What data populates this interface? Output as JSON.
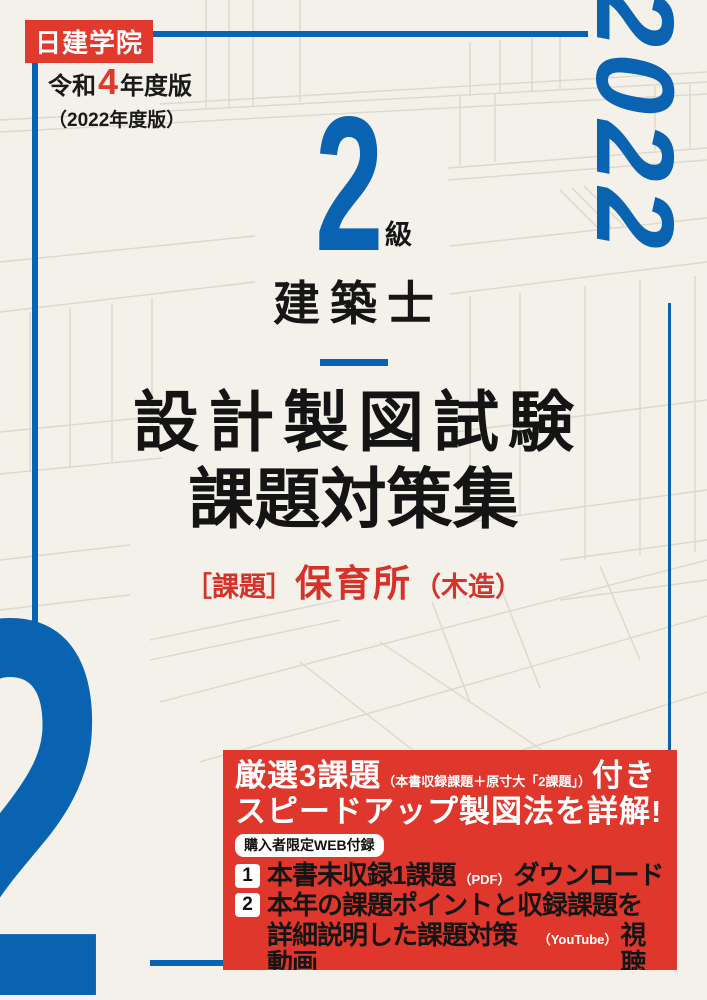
{
  "colors": {
    "brand_blue": "#0a63b1",
    "brand_red": "#e1392c",
    "promo_red": "#df372b",
    "background": "#f3f1ea",
    "ink": "#161616"
  },
  "header": {
    "logo": "日建学院",
    "era_prefix": "令和",
    "era_digit": "4",
    "era_suffix": "年度版",
    "western_year": "（2022年度版）",
    "year_vertical": "2022"
  },
  "center": {
    "grade_digit": "2",
    "grade_suffix": "級",
    "license": "建築士",
    "title_line1": "設計製図試験",
    "title_line2": "課題対策集",
    "subject_bracket": "［課題］",
    "subject_name": "保育所",
    "subject_note": "（木造）"
  },
  "bottom": {
    "big_digit": "2"
  },
  "promo": {
    "headline_lead": "厳選3課題",
    "headline_paren": "（本書収録課題＋原寸大「2課題」）",
    "headline_tail": "付き",
    "headline_line2": "スピードアップ製図法を詳解!",
    "web_badge": "購入者限定WEB付録",
    "item1": {
      "num": "1",
      "main": "本書未収録1課題",
      "paren": "（PDF）",
      "tail": "ダウンロード"
    },
    "item2": {
      "num": "2",
      "line1": "本年の課題ポイントと収録課題を",
      "line2_main": "詳細説明した課題対策動画",
      "line2_paren": "（YouTube）",
      "line2_tail": "視聴"
    },
    "footnote": "巻末封筒内のQRコードよりお申込みで、パスワードを進呈!"
  }
}
